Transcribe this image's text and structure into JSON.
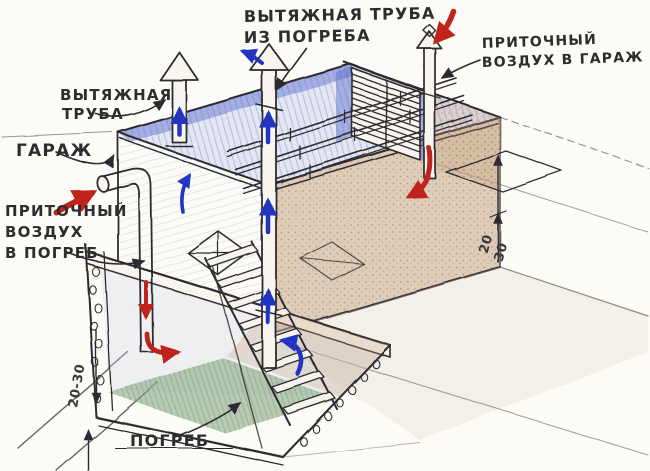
{
  "drawing": {
    "type": "hand-drawn ventilation scheme of a garage with a cellar",
    "labels": {
      "exhaust_from_cellar": {
        "line1": "ВЫТЯЖНАЯ ТРУБА",
        "line2": "ИЗ ПОГРЕБА"
      },
      "supply_to_garage": {
        "line1": "ПРИТОЧНЫЙ",
        "line2": "ВОЗДУХ В ГАРАЖ"
      },
      "exhaust_pipe": {
        "line1": "ВЫТЯЖНАЯ",
        "line2": "ТРУБА"
      },
      "garage": "ГАРАЖ",
      "supply_to_cellar": {
        "line1": "ПРИТОЧНЫЙ",
        "line2": "ВОЗДУХ",
        "line3": "В ПОГРЕБ"
      },
      "cellar": "ПОГРЕБ",
      "dim_cellar_wall": "20-30",
      "dim_right_upper": "20",
      "dim_right_lower": "30"
    },
    "colors": {
      "paper": "#fcfbf5",
      "ink": "#2e2c30",
      "blue_arrow": "#2334c0",
      "red_arrow": "#c0221a",
      "pencil_blue": "#5668cc",
      "pencil_sepia": "#b08963",
      "pencil_green": "#6d9c70"
    }
  }
}
